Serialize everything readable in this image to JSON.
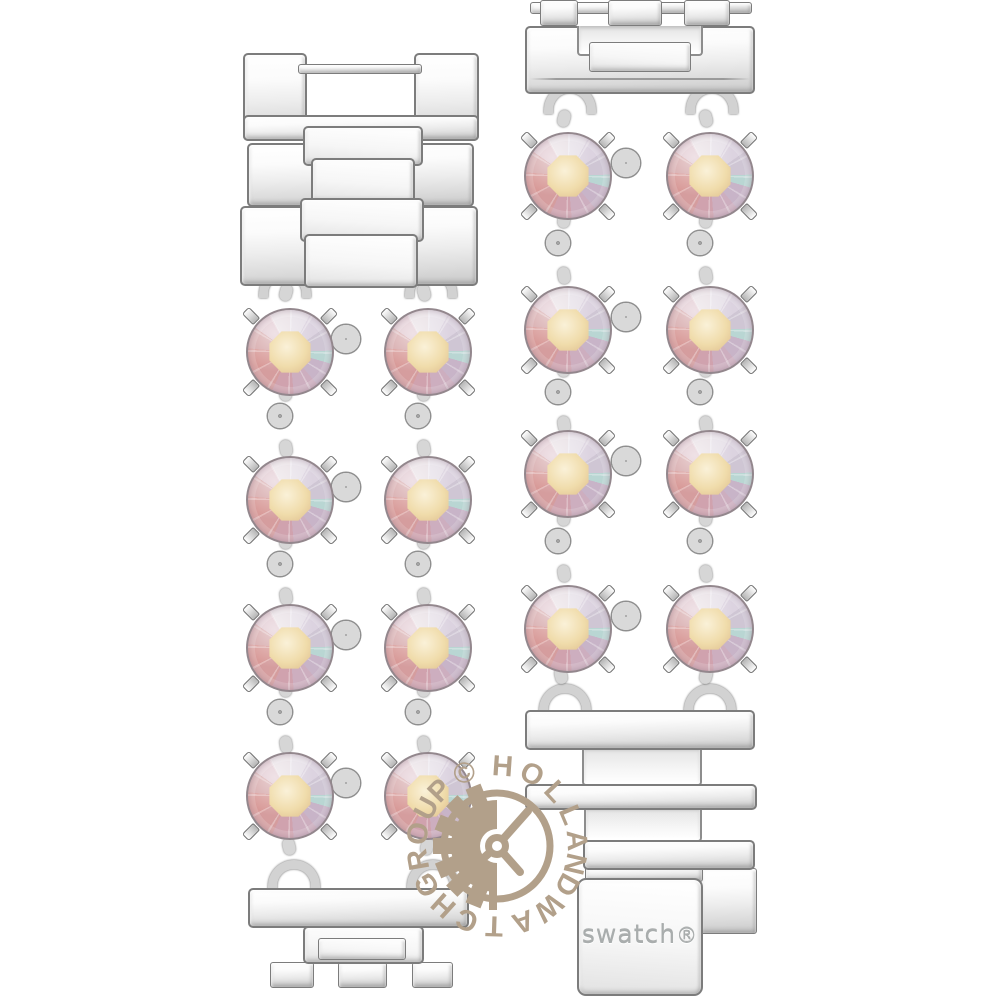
{
  "image": {
    "alt": "Swatch stainless steel watch bracelet: two strap segments set with iridescent round crystals, polished folding clasp links, photographed on white",
    "background": "#ffffff"
  },
  "branding": {
    "engraving": "swatch",
    "registered": "®"
  },
  "watermark": {
    "text": "© HOLLAND WATCH GROUP",
    "ring_chars": "©HOLLANDWATCHGROUP",
    "color": "#b2a08a",
    "icon": "gear-clock-watermark-icon"
  },
  "materials": {
    "metal_highlight": "#ffffff",
    "metal_mid": "#e6e6e6",
    "metal_shadow": "#c6c6c6",
    "metal_edge": "#7c7c7c",
    "crystal_table": "#f0dcab",
    "crystal_pink": "#d79795",
    "crystal_lavender": "#cfc6d4",
    "crystal_cyan": "#b9d6d3"
  },
  "structure": {
    "left_strap": {
      "clasp_links": 3,
      "crystal_rows": 4,
      "crystals_per_row": 2,
      "end_feet": 3
    },
    "right_strap": {
      "top_end_links": 1,
      "crystal_rows": 4,
      "crystals_per_row": 2,
      "bottom_links": 4
    }
  }
}
